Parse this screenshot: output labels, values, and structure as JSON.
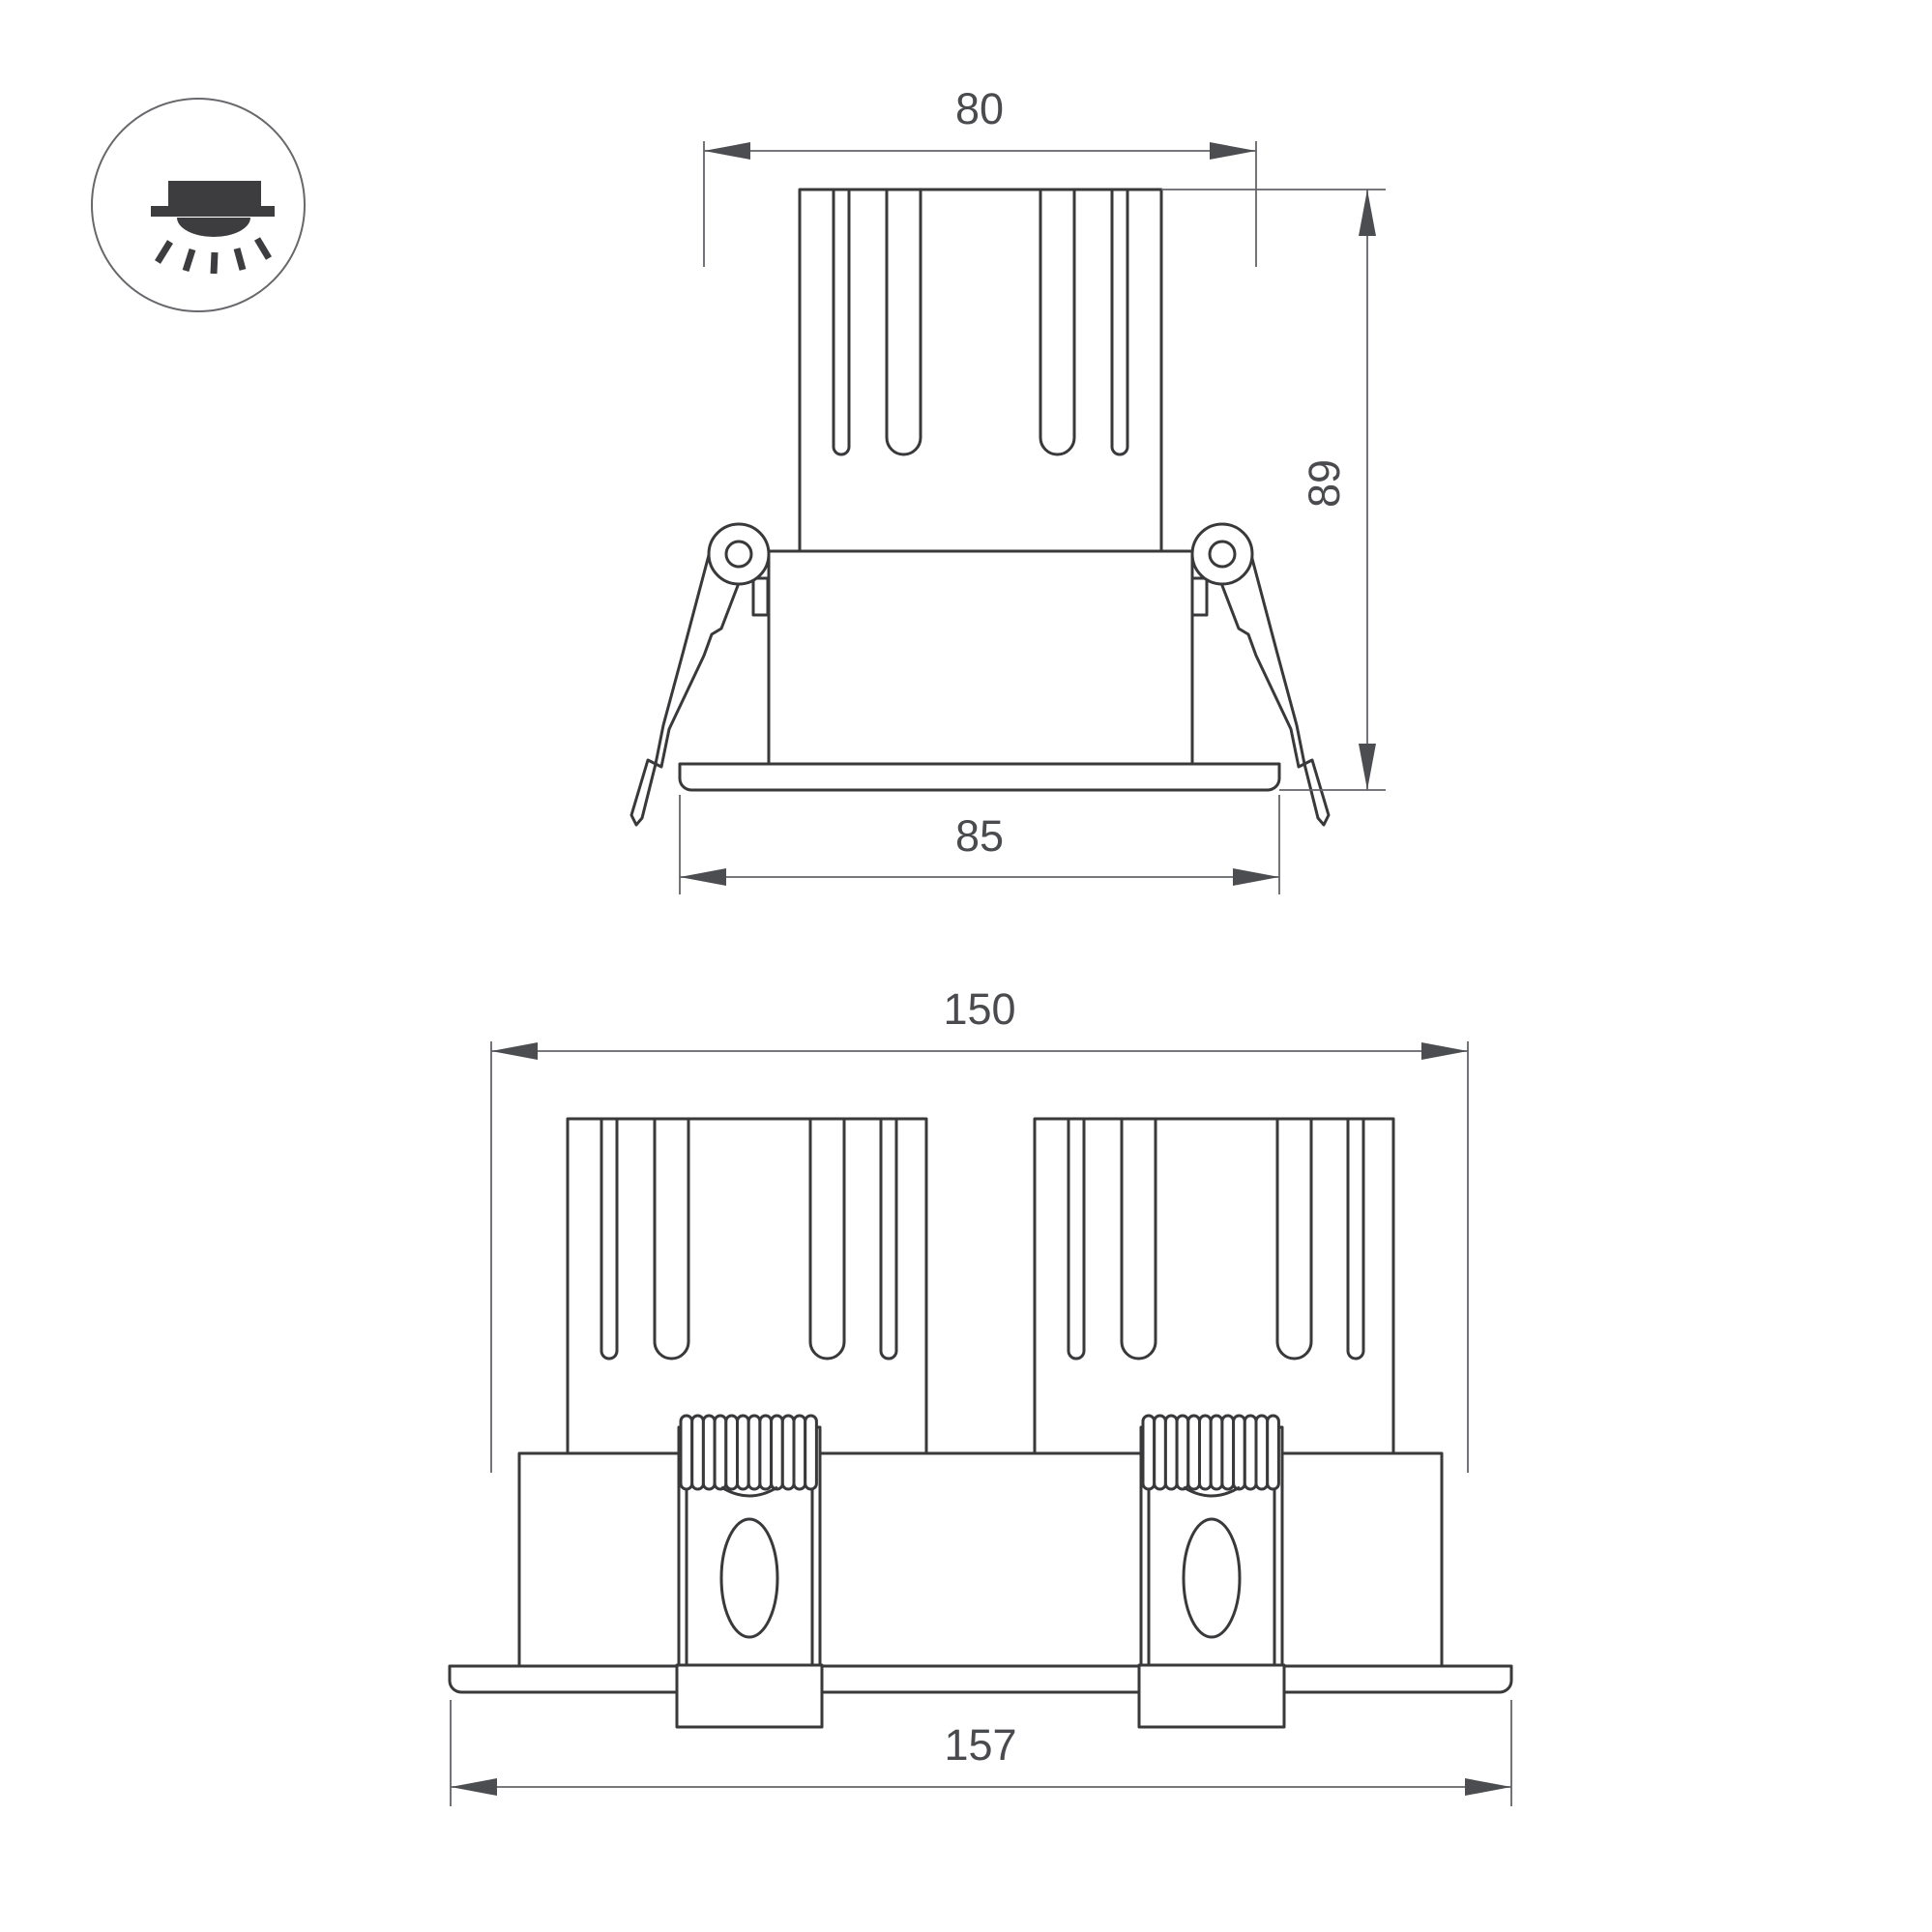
{
  "document": {
    "type": "technical-dimension-drawing",
    "subject": "recessed-downlight-luminaire",
    "background": "#ffffff"
  },
  "colors": {
    "object_line": "#39383b",
    "dimension_line": "#63646a",
    "arrowhead": "#4c4d51",
    "label_text": "#4a4b4e",
    "icon": "#3d3d40"
  },
  "icon": {
    "name": "recessed-ceiling-light-icon",
    "description": "circle containing recessed downlight with ceiling line and light rays"
  },
  "dimensions": {
    "single_view": {
      "cutout_width": "80",
      "height": "89",
      "flange_width": "85"
    },
    "dual_view": {
      "cutout_width": "150",
      "flange_width": "157"
    }
  }
}
